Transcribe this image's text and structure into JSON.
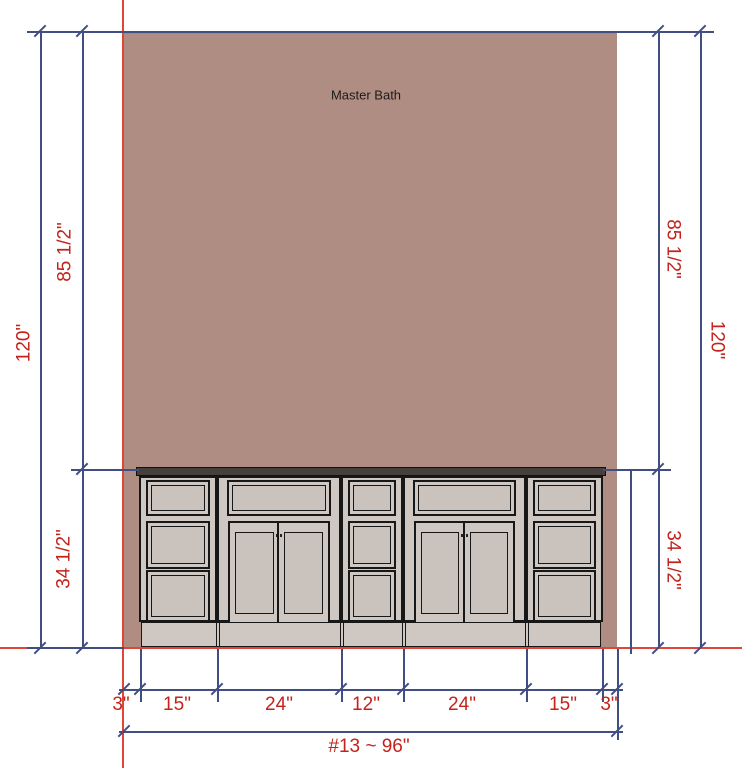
{
  "room": {
    "label": "Master Bath"
  },
  "dims": {
    "left": [
      {
        "label": "120\""
      },
      {
        "label": "85 1/2\""
      },
      {
        "label": "34 1/2\""
      }
    ],
    "right": [
      {
        "label": "85 1/2\""
      },
      {
        "label": "120\""
      },
      {
        "label": "34 1/2\""
      }
    ],
    "bottom": [
      {
        "label": "3\""
      },
      {
        "label": "15\""
      },
      {
        "label": "24\""
      },
      {
        "label": "12\""
      },
      {
        "label": "24\""
      },
      {
        "label": "15\""
      },
      {
        "label": "3\""
      }
    ],
    "overall": {
      "label": "#13 ~ 96\""
    }
  },
  "cabinets": [
    {
      "type": "filler-gap",
      "width_label": "3\""
    },
    {
      "type": "3-drawer-bank",
      "width_label": "15\""
    },
    {
      "type": "2-door-base-with-top-drawer",
      "width_label": "24\""
    },
    {
      "type": "3-drawer-bank",
      "width_label": "12\""
    },
    {
      "type": "2-door-base-with-top-drawer",
      "width_label": "24\""
    },
    {
      "type": "3-drawer-bank",
      "width_label": "15\""
    },
    {
      "type": "filler-gap",
      "width_label": "3\""
    }
  ],
  "colors": {
    "wall": "#b08d82",
    "dim_line": "#414e82",
    "dim_text": "#c2231b",
    "construction_line": "#e04539",
    "cabinet_fill": "#cec7c2",
    "cabinet_line": "#171717",
    "counter": "#45403c",
    "room_text": "#1b1b1b"
  }
}
